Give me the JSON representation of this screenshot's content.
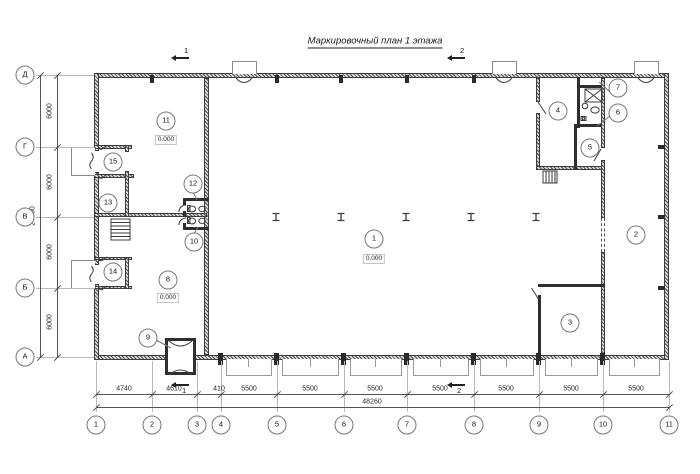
{
  "title": "Маркировочный план 1 этажа",
  "axes": {
    "rows": [
      "Д",
      "Г",
      "В",
      "Б",
      "А"
    ],
    "cols": [
      "1",
      "2",
      "3",
      "4",
      "5",
      "6",
      "7",
      "8",
      "9",
      "10",
      "11"
    ]
  },
  "dimensions": {
    "bottom_segments": [
      "4740",
      "4610",
      "410",
      "5500",
      "5500",
      "5500",
      "5500",
      "5500",
      "5500",
      "5500"
    ],
    "bottom_total": "48260",
    "left_segments": [
      "6000",
      "6000",
      "6000",
      "6000"
    ],
    "left_total": "24000"
  },
  "rooms": [
    {
      "number": "1",
      "elevation": "0.000"
    },
    {
      "number": "2"
    },
    {
      "number": "3"
    },
    {
      "number": "4"
    },
    {
      "number": "5"
    },
    {
      "number": "6"
    },
    {
      "number": "7"
    },
    {
      "number": "8",
      "elevation": "0.000"
    },
    {
      "number": "9"
    },
    {
      "number": "10"
    },
    {
      "number": "11",
      "elevation": "0.000"
    },
    {
      "number": "12"
    },
    {
      "number": "13"
    },
    {
      "number": "14"
    },
    {
      "number": "15"
    }
  ],
  "sections": {
    "labels": [
      "1",
      "2"
    ]
  }
}
